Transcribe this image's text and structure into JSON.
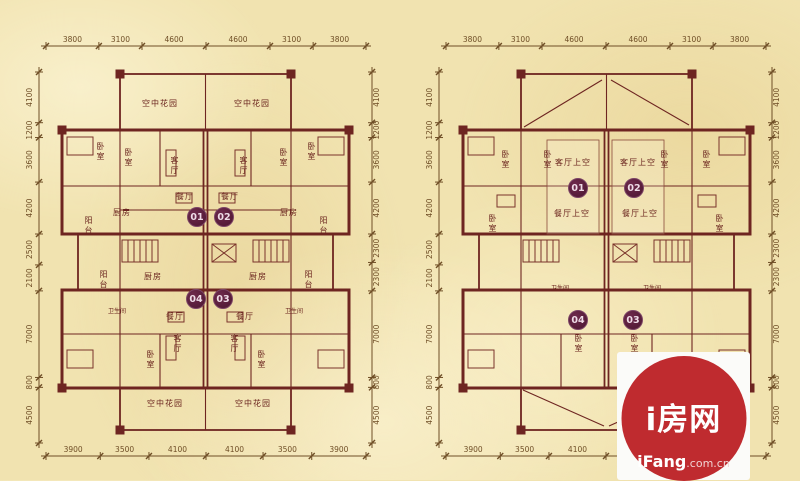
{
  "colors": {
    "background": "#f1e3b0",
    "wall": "#6e2521",
    "dimension_text": "#6f4e26",
    "room_label": "#6a241e",
    "unit_badge": "#5c1d3c",
    "watermark_red": "#bf2b2f",
    "watermark_box": "#fbfbf9"
  },
  "watermark": {
    "brand": "i房网",
    "site": "iFang",
    "domain": ".com.cn"
  },
  "left_plan": {
    "rooms": {
      "sky_garden": "空中花园",
      "bedroom": "卧室",
      "living": "客厅",
      "dining": "餐厅",
      "kitchen": "厨房",
      "balcony": "阳台",
      "bath": "卫生间"
    },
    "units": {
      "u01": "01",
      "u02": "02",
      "u03": "03",
      "u04": "04"
    },
    "dims": {
      "top": [
        "3800",
        "3100",
        "4600",
        "4600",
        "3100",
        "3800"
      ],
      "bottom": [
        "3900",
        "3500",
        "4100",
        "4100",
        "3500",
        "3900"
      ],
      "left": [
        "4100",
        "1200",
        "3600",
        "4200",
        "2500",
        "2100",
        "7000",
        "800",
        "4500"
      ],
      "right": [
        "4100",
        "1200",
        "3600",
        "4200",
        "2300",
        "2300",
        "7000",
        "800",
        "4500"
      ]
    }
  },
  "right_plan": {
    "rooms": {
      "bedroom": "卧室",
      "living_void": "客厅上空",
      "dining_void": "餐厅上空",
      "bath": "卫生间"
    },
    "units": {
      "u01": "01",
      "u02": "02",
      "u03": "03",
      "u04": "04"
    },
    "dims": {
      "top": [
        "3800",
        "3100",
        "4600",
        "4600",
        "3100",
        "3800"
      ],
      "bottom": [
        "3900",
        "3500",
        "4100",
        "4100",
        "3500",
        "3900"
      ],
      "left": [
        "4100",
        "1200",
        "3600",
        "4200",
        "2500",
        "2100",
        "7000",
        "800",
        "4500"
      ],
      "right": [
        "4100",
        "1200",
        "3600",
        "4200",
        "2300",
        "2300",
        "7000",
        "800",
        "4500"
      ]
    }
  }
}
